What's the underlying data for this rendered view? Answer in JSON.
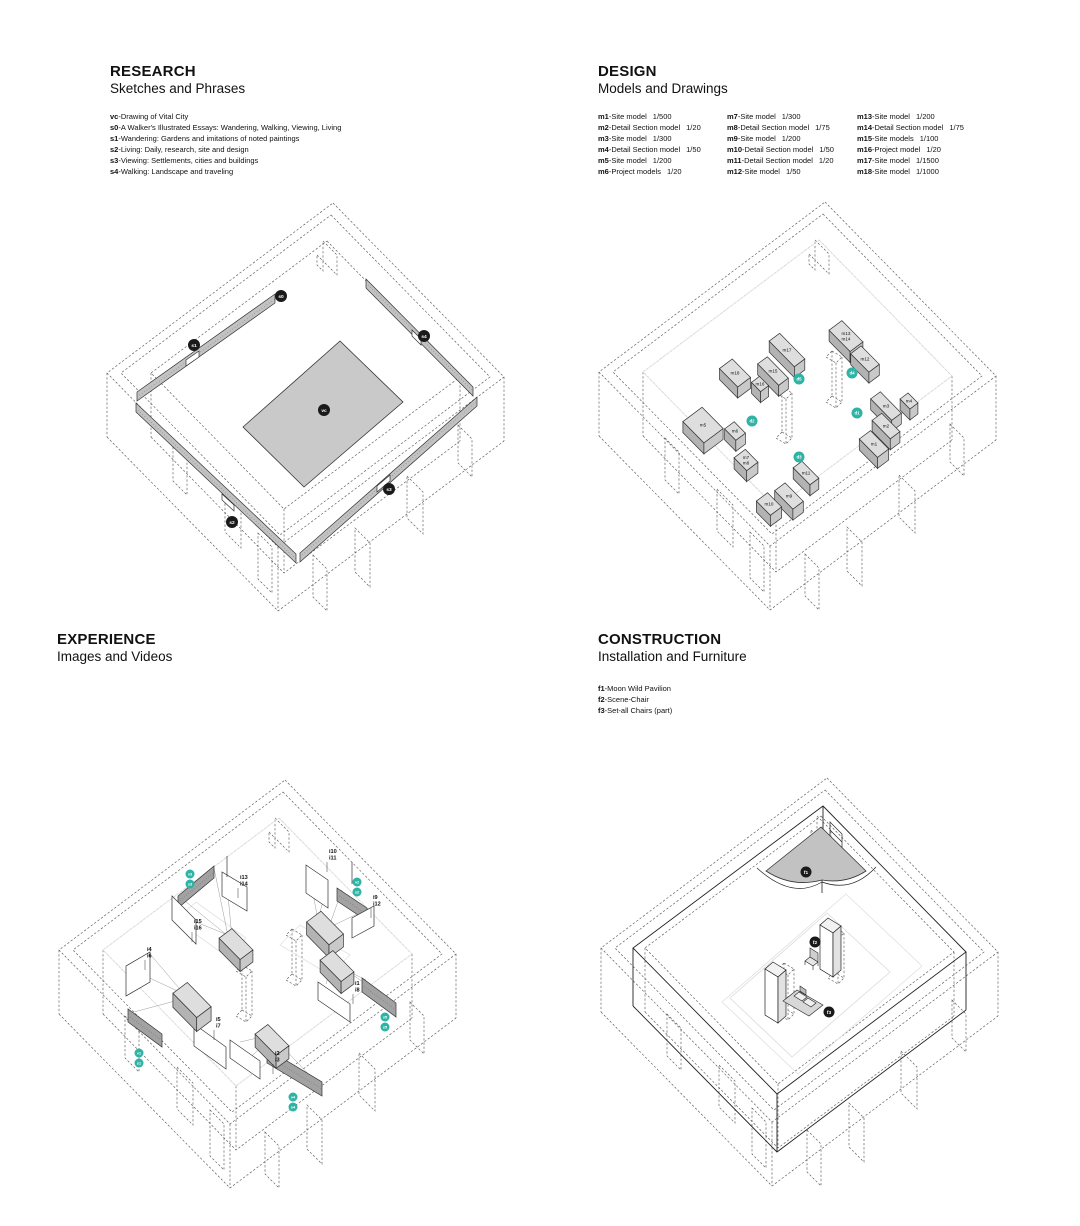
{
  "sections": {
    "research": {
      "title": "RESEARCH",
      "subtitle": "Sketches and Phrases",
      "legend": [
        {
          "code": "vc",
          "text": "Drawing of Vital City"
        },
        {
          "code": "s0",
          "text": "A Walker's Illustrated Essays: Wandering, Walking, Viewing, Living"
        },
        {
          "code": "s1",
          "text": "Wandering: Gardens and imitations of noted paintings"
        },
        {
          "code": "s2",
          "text": "Living: Daily, research, site and design"
        },
        {
          "code": "s3",
          "text": "Viewing: Settlements, cities and buildings"
        },
        {
          "code": "s4",
          "text": "Walking: Landscape and traveling"
        }
      ]
    },
    "design": {
      "title": "DESIGN",
      "subtitle": "Models and Drawings",
      "legend_columns": [
        [
          {
            "code": "m1",
            "name": "Site model",
            "scale": "1/500"
          },
          {
            "code": "m2",
            "name": "Detail Section model",
            "scale": "1/20"
          },
          {
            "code": "m3",
            "name": "Site model",
            "scale": "1/300"
          },
          {
            "code": "m4",
            "name": "Detail Section model",
            "scale": "1/50"
          },
          {
            "code": "m5",
            "name": "Site model",
            "scale": "1/200"
          },
          {
            "code": "m6",
            "name": "Project models",
            "scale": "1/20"
          }
        ],
        [
          {
            "code": "m7",
            "name": "Site model",
            "scale": "1/300"
          },
          {
            "code": "m8",
            "name": "Detail Section model",
            "scale": "1/75"
          },
          {
            "code": "m9",
            "name": "Site model",
            "scale": "1/200"
          },
          {
            "code": "m10",
            "name": "Detail Section model",
            "scale": "1/50"
          },
          {
            "code": "m11",
            "name": "Detail Section model",
            "scale": "1/20"
          },
          {
            "code": "m12",
            "name": "Site model",
            "scale": "1/50"
          }
        ],
        [
          {
            "code": "m13",
            "name": "Site model",
            "scale": "1/200"
          },
          {
            "code": "m14",
            "name": "Detail Section model",
            "scale": "1/75"
          },
          {
            "code": "m15",
            "name": "Site models",
            "scale": "1/100"
          },
          {
            "code": "m16",
            "name": "Project model",
            "scale": "1/20"
          },
          {
            "code": "m17",
            "name": "Site model",
            "scale": "1/1500"
          },
          {
            "code": "m18",
            "name": "Site model",
            "scale": "1/1000"
          }
        ]
      ]
    },
    "experience": {
      "title": "EXPERIENCE",
      "subtitle": "Images and Videos"
    },
    "construction": {
      "title": "CONSTRUCTION",
      "subtitle": "Installation and Furniture",
      "legend": [
        {
          "code": "f1",
          "text": "Moon Wild Pavilion"
        },
        {
          "code": "f2",
          "text": "Scene-Chair"
        },
        {
          "code": "f3",
          "text": "Set-all Chairs (part)"
        }
      ]
    }
  },
  "drawings": {
    "research": {
      "badges": {
        "vc": "vc",
        "s0": "s0",
        "s1": "s1",
        "s2": "s2",
        "s3": "s3",
        "s4": "s4"
      }
    },
    "design": {
      "box_labels": {
        "m1": "m1",
        "m2": "m2",
        "m3": "m3",
        "m4": "m4",
        "m5": "m5",
        "m6": "m6",
        "m7": "m7",
        "m8": "m8",
        "m9": "m9",
        "m10": "m10",
        "m11": "m11",
        "m12": "m12",
        "m13": "m13",
        "m14": "m14",
        "m15": "m15",
        "m16": "m16",
        "m17": "m17",
        "m18": "m18"
      },
      "area_badges": {
        "d1": "d1",
        "d2": "d2",
        "d3": "d3",
        "d4": "d4",
        "d5": "d5"
      }
    },
    "experience": {
      "labels": {
        "i1": "i1",
        "i2": "i2",
        "i3": "i3",
        "i4": "i4",
        "i5": "i5",
        "i6": "i6",
        "i7": "i7",
        "i8": "i8",
        "i9": "i9",
        "i10": "i10",
        "i11": "i11",
        "i12": "i12",
        "i13": "i13",
        "i14": "i14",
        "i15": "i15",
        "i16": "i16"
      },
      "badges": {
        "v1": "v1",
        "s1": "s1",
        "v2": "v2",
        "s2": "s2",
        "v3": "v3",
        "s3": "s3",
        "v4": "v4",
        "s4": "s4",
        "v5": "v5",
        "s5": "s5"
      }
    },
    "construction": {
      "badges": {
        "f1": "f1",
        "f2": "f2",
        "f3": "f3"
      }
    }
  },
  "colors": {
    "accent_teal": "#2fb3a4",
    "badge_black": "#1a1a1a",
    "panel_grey": "#c9c9c9",
    "strip_grey": "#c2c2c2",
    "box_top": "#dedede",
    "box_left": "#b3b3b3",
    "box_right": "#c9c9c9"
  }
}
